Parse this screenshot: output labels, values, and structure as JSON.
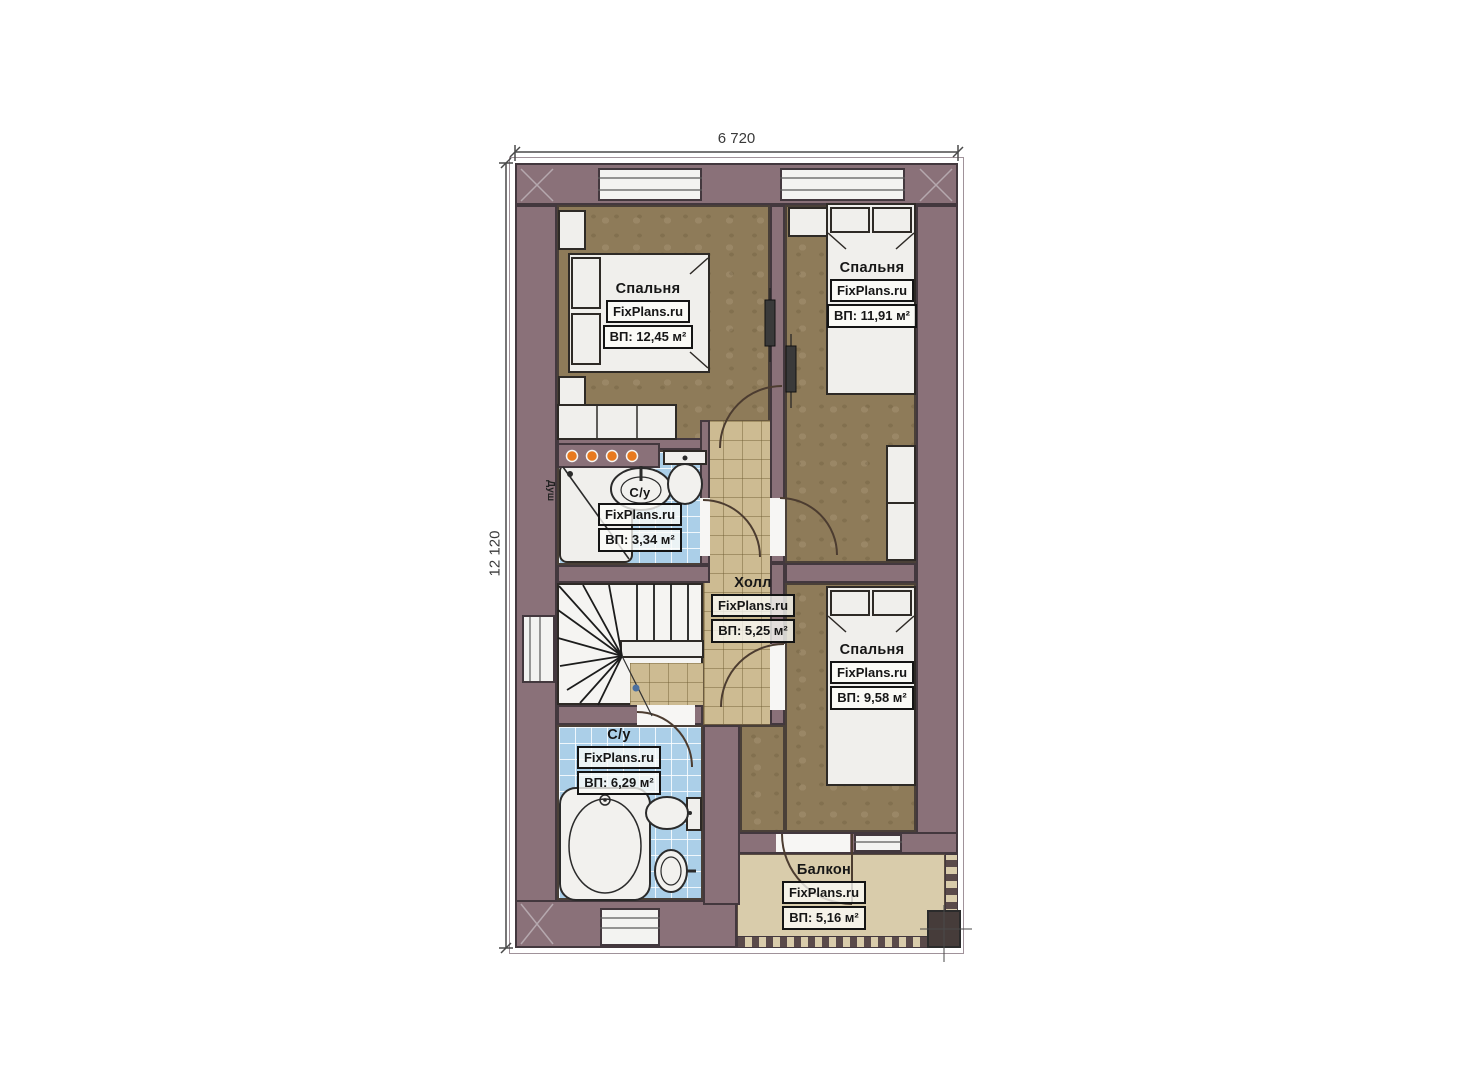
{
  "plan": {
    "type": "floor-plan",
    "dimensions": {
      "width_label": "6 720",
      "height_label": "12 120"
    },
    "rooms": {
      "bedroom_top_left": {
        "name": "Спальня",
        "brand": "FixPlans.ru",
        "area": "ВП: 12,45 м²"
      },
      "bedroom_top_right": {
        "name": "Спальня",
        "brand": "FixPlans.ru",
        "area": "ВП: 11,91 м²"
      },
      "bathroom_small": {
        "name": "С/у",
        "brand": "FixPlans.ru",
        "area": "ВП: 3,34 м²"
      },
      "hall": {
        "name": "Холл",
        "brand": "FixPlans.ru",
        "area": "ВП: 5,25 м²"
      },
      "bedroom_right": {
        "name": "Спальня",
        "brand": "FixPlans.ru",
        "area": "ВП: 9,58 м²"
      },
      "bathroom_large": {
        "name": "С/у",
        "brand": "FixPlans.ru",
        "area": "ВП: 6,29 м²"
      },
      "balcony": {
        "name": "Балкон",
        "brand": "FixPlans.ru",
        "area": "ВП: 5,16 м²"
      }
    },
    "labels": {
      "shower": "Душ"
    },
    "colors": {
      "wall": "#8a7179",
      "wall_line": "#43383e",
      "bedroom_floor": "#8e7b59",
      "hall_floor": "#cdbb92",
      "bathroom_floor": "#abcfe8",
      "balcony_floor": "#d9ccab",
      "fixture": "#f0efec",
      "accent_lamp": "#e87a1f"
    }
  }
}
